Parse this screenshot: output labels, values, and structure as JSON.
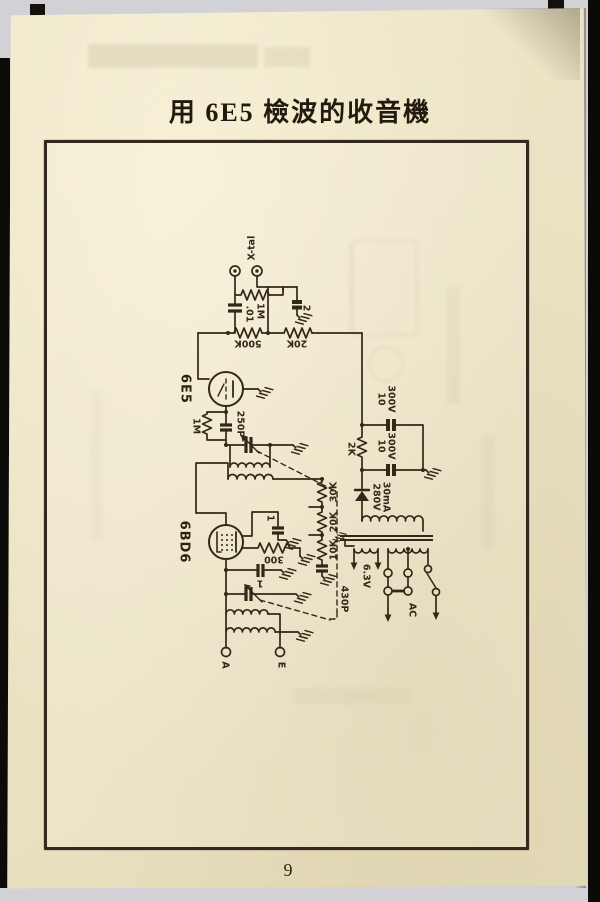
{
  "page": {
    "title": "用 6E5 檢波的收音機",
    "page_number": "9"
  },
  "schematic": {
    "tubes": {
      "detector": "6E5",
      "if_amp": "6BD6"
    },
    "labels": {
      "xtal": "X-tal",
      "c_01": ".01",
      "r_1m_top": "1M",
      "c_2": "2",
      "r_500k": "500K",
      "r_20k": "20K",
      "r_1m_grid": "1M",
      "c_250p": "250P",
      "r_2k": "2K",
      "cap_a_uf": "10",
      "cap_a_v": "300V",
      "cap_b_uf": "10",
      "cap_b_v": "300V",
      "hv_volts": "280V",
      "hv_current": "30mA",
      "r_30k": "30K",
      "r_20k_div": "20K",
      "r_10k": "10K",
      "r_300": "300",
      "c_screen": "1",
      "c_cathode": "1",
      "c_430p": "430P",
      "heater_v": "6.3V",
      "ac": "AC",
      "ant_terminal": "A",
      "earth_terminal": "E"
    },
    "colors": {
      "ink": "#32281a",
      "paper": "#eae2c3"
    }
  }
}
